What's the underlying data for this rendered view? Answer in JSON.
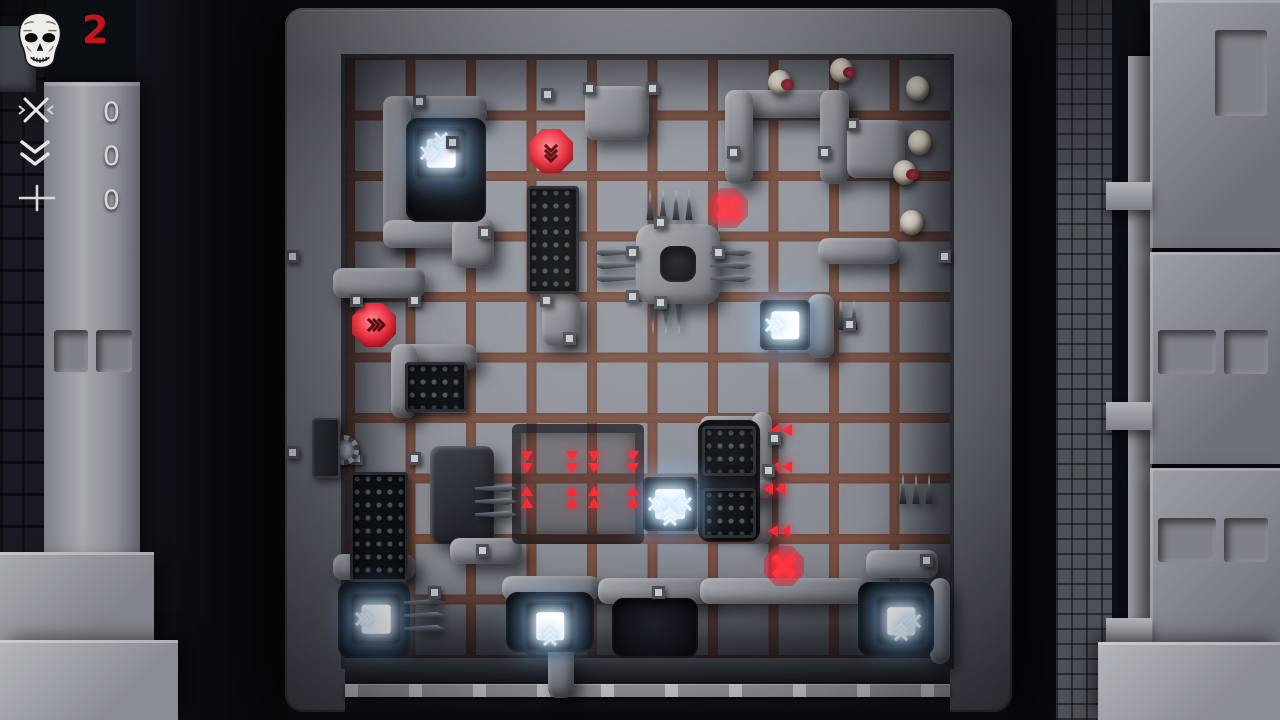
{
  "colors": {
    "accent_red": "#c3151c",
    "glow_red": "#ff2330",
    "glow_white": "#eaf6ff",
    "stone": "#8b8e94",
    "floor_frame": "#6f4a3d",
    "floor_tile": "#94979f"
  },
  "hud": {
    "threat_count": "2",
    "counters": [
      {
        "icon": "cross-icon",
        "value": "0"
      },
      {
        "icon": "double-chevron-down-icon",
        "value": "0"
      },
      {
        "icon": "plus-icon",
        "value": "0"
      }
    ]
  },
  "board": {
    "grid": {
      "origin_x": 345,
      "origin_y": 58,
      "cols": 10,
      "rows": 10,
      "pitch": 60.5
    },
    "walls": [
      {
        "x": 383,
        "y": 96,
        "w": 104,
        "h": 28
      },
      {
        "x": 383,
        "y": 96,
        "w": 28,
        "h": 152
      },
      {
        "x": 383,
        "y": 220,
        "w": 104,
        "h": 28
      },
      {
        "x": 452,
        "y": 218,
        "w": 42,
        "h": 50
      },
      {
        "x": 585,
        "y": 86,
        "w": 64,
        "h": 54
      },
      {
        "x": 725,
        "y": 90,
        "w": 124,
        "h": 28
      },
      {
        "x": 725,
        "y": 90,
        "w": 28,
        "h": 94
      },
      {
        "x": 820,
        "y": 90,
        "w": 29,
        "h": 94
      },
      {
        "x": 847,
        "y": 120,
        "w": 58,
        "h": 58
      },
      {
        "x": 333,
        "y": 268,
        "w": 92,
        "h": 30
      },
      {
        "x": 542,
        "y": 294,
        "w": 38,
        "h": 52
      },
      {
        "x": 391,
        "y": 344,
        "w": 86,
        "h": 26
      },
      {
        "x": 391,
        "y": 344,
        "w": 26,
        "h": 74
      },
      {
        "x": 818,
        "y": 238,
        "w": 82,
        "h": 26
      },
      {
        "x": 808,
        "y": 294,
        "w": 26,
        "h": 64
      },
      {
        "x": 700,
        "y": 416,
        "w": 72,
        "h": 18
      },
      {
        "x": 752,
        "y": 412,
        "w": 20,
        "h": 132
      },
      {
        "x": 700,
        "y": 480,
        "w": 72,
        "h": 18
      },
      {
        "x": 430,
        "y": 446,
        "w": 64,
        "h": 98,
        "dark": true
      },
      {
        "x": 333,
        "y": 554,
        "w": 82,
        "h": 26
      },
      {
        "x": 450,
        "y": 538,
        "w": 72,
        "h": 26
      },
      {
        "x": 502,
        "y": 576,
        "w": 98,
        "h": 24
      },
      {
        "x": 548,
        "y": 644,
        "w": 26,
        "h": 54
      },
      {
        "x": 598,
        "y": 578,
        "w": 114,
        "h": 26
      },
      {
        "x": 700,
        "y": 578,
        "w": 170,
        "h": 26
      },
      {
        "x": 866,
        "y": 550,
        "w": 72,
        "h": 28
      },
      {
        "x": 930,
        "y": 578,
        "w": 20,
        "h": 86
      }
    ],
    "ring": {
      "x": 636,
      "y": 224,
      "w": 84,
      "h": 80
    },
    "pits": [
      {
        "x": 406,
        "y": 118,
        "w": 80,
        "h": 104
      },
      {
        "x": 338,
        "y": 582,
        "w": 72,
        "h": 76
      },
      {
        "x": 506,
        "y": 592,
        "w": 88,
        "h": 60
      },
      {
        "x": 612,
        "y": 598,
        "w": 86,
        "h": 60
      },
      {
        "x": 858,
        "y": 582,
        "w": 76,
        "h": 74
      },
      {
        "x": 698,
        "y": 420,
        "w": 62,
        "h": 122
      }
    ],
    "grates": [
      {
        "x": 527,
        "y": 186,
        "w": 52,
        "h": 108
      },
      {
        "x": 405,
        "y": 362,
        "w": 62,
        "h": 50
      },
      {
        "x": 350,
        "y": 472,
        "w": 58,
        "h": 110
      },
      {
        "x": 702,
        "y": 426,
        "w": 54,
        "h": 50
      },
      {
        "x": 702,
        "y": 488,
        "w": 54,
        "h": 50
      }
    ],
    "trapzone": {
      "x": 512,
      "y": 424,
      "w": 132,
      "h": 120
    },
    "spikes": [
      {
        "x": 645,
        "y": 190,
        "dir": "up",
        "n": 4
      },
      {
        "x": 593,
        "y": 248,
        "dir": "left",
        "n": 3
      },
      {
        "x": 710,
        "y": 248,
        "dir": "right",
        "n": 3
      },
      {
        "x": 648,
        "y": 304,
        "dir": "down",
        "n": 3
      },
      {
        "x": 475,
        "y": 484,
        "dir": "right",
        "n": 3
      },
      {
        "x": 404,
        "y": 598,
        "dir": "right",
        "n": 3
      },
      {
        "x": 836,
        "y": 300,
        "dir": "up",
        "n": 2
      },
      {
        "x": 898,
        "y": 474,
        "dir": "up",
        "n": 3
      }
    ],
    "fans": [
      {
        "x": 415,
        "y": 127,
        "s": 52,
        "ch": [
          "down",
          "right"
        ]
      },
      {
        "x": 760,
        "y": 300,
        "s": 50,
        "ch": [
          "right"
        ]
      },
      {
        "x": 643,
        "y": 477,
        "s": 54,
        "ch": [
          "left",
          "right",
          "up"
        ]
      },
      {
        "x": 350,
        "y": 593,
        "s": 52,
        "ch": [
          "right"
        ]
      },
      {
        "x": 525,
        "y": 601,
        "s": 50,
        "ch": [
          "up"
        ]
      },
      {
        "x": 876,
        "y": 596,
        "s": 50,
        "ch": [
          "left",
          "up"
        ]
      }
    ],
    "buttons": [
      {
        "x": 529,
        "y": 129,
        "s": 44,
        "dir": "down"
      },
      {
        "x": 352,
        "y": 303,
        "s": 44,
        "dir": "right"
      }
    ],
    "xmarks": [
      {
        "x": 708,
        "y": 188,
        "s": 40
      },
      {
        "x": 764,
        "y": 546,
        "s": 40
      }
    ],
    "arrows": [
      {
        "x": 521,
        "y": 451,
        "dir": "down"
      },
      {
        "x": 521,
        "y": 486,
        "dir": "up"
      },
      {
        "x": 566,
        "y": 451,
        "dir": "down"
      },
      {
        "x": 566,
        "y": 486,
        "dir": "up"
      },
      {
        "x": 588,
        "y": 451,
        "dir": "down"
      },
      {
        "x": 588,
        "y": 486,
        "dir": "up"
      },
      {
        "x": 627,
        "y": 451,
        "dir": "down"
      },
      {
        "x": 627,
        "y": 486,
        "dir": "up"
      },
      {
        "x": 770,
        "y": 424,
        "dir": "left"
      },
      {
        "x": 770,
        "y": 461,
        "dir": "left"
      },
      {
        "x": 763,
        "y": 483,
        "dir": "left"
      },
      {
        "x": 768,
        "y": 525,
        "dir": "left"
      }
    ],
    "zombies": [
      {
        "x": 768,
        "y": 70,
        "red": true
      },
      {
        "x": 830,
        "y": 58,
        "red": true
      },
      {
        "x": 906,
        "y": 76,
        "red": false
      },
      {
        "x": 908,
        "y": 130,
        "red": false
      },
      {
        "x": 893,
        "y": 160,
        "red": true
      },
      {
        "x": 900,
        "y": 210,
        "red": false
      }
    ],
    "gear": {
      "x": 329,
      "y": 435,
      "s": 30
    },
    "machine": {
      "x": 312,
      "y": 418,
      "w": 28,
      "h": 60
    },
    "brackets": [
      [
        413,
        95
      ],
      [
        446,
        136
      ],
      [
        478,
        226
      ],
      [
        541,
        88
      ],
      [
        583,
        82
      ],
      [
        646,
        82
      ],
      [
        626,
        246
      ],
      [
        626,
        290
      ],
      [
        712,
        246
      ],
      [
        654,
        216
      ],
      [
        654,
        296
      ],
      [
        727,
        146
      ],
      [
        818,
        146
      ],
      [
        846,
        118
      ],
      [
        350,
        294
      ],
      [
        408,
        294
      ],
      [
        540,
        294
      ],
      [
        563,
        332
      ],
      [
        350,
        452
      ],
      [
        408,
        452
      ],
      [
        768,
        432
      ],
      [
        762,
        464
      ],
      [
        476,
        544
      ],
      [
        428,
        586
      ],
      [
        920,
        554
      ],
      [
        286,
        250
      ],
      [
        286,
        446
      ],
      [
        938,
        250
      ],
      [
        652,
        586
      ],
      [
        843,
        318
      ]
    ]
  }
}
